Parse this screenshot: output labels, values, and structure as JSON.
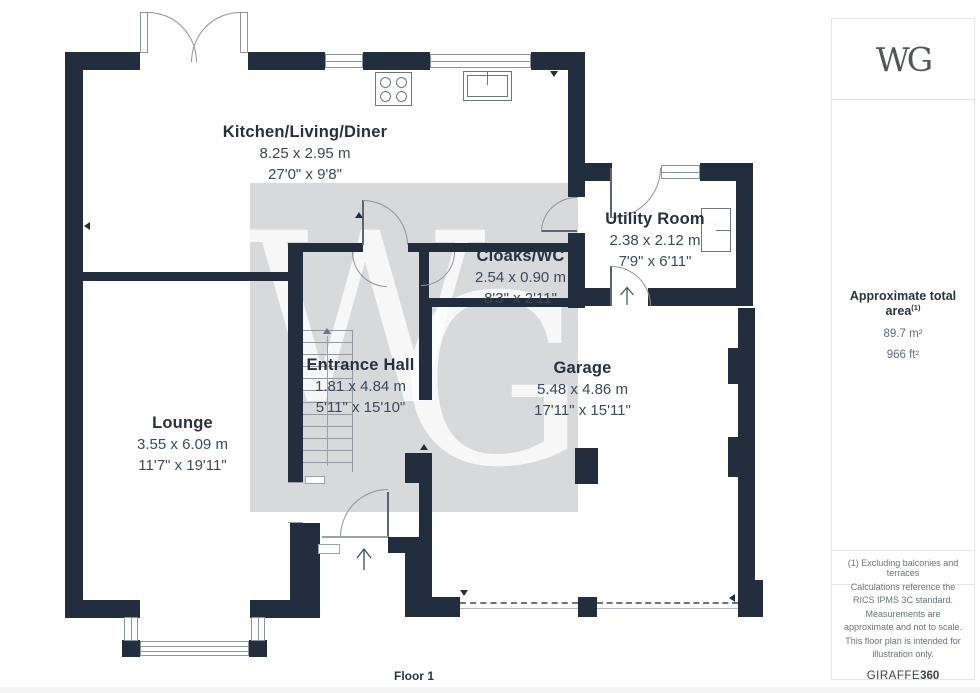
{
  "plan": {
    "floor_label": "Floor 1",
    "wall_color": "#222d3d",
    "watermark_letter_w": "W",
    "watermark_letter_g": "G",
    "rooms": [
      {
        "name": "Kitchen/Living/Diner",
        "metric": "8.25 x 2.95 m",
        "imperial": "27'0\" x 9'8\""
      },
      {
        "name": "Utility Room",
        "metric": "2.38 x 2.12 m",
        "imperial": "7'9\" x 6'11\""
      },
      {
        "name": "Cloaks/WC",
        "metric": "2.54 x 0.90 m",
        "imperial": "8'3\" x 2'11\""
      },
      {
        "name": "Entrance Hall",
        "metric": "1.81 x 4.84 m",
        "imperial": "5'11\" x 15'10\""
      },
      {
        "name": "Garage",
        "metric": "5.48 x 4.86 m",
        "imperial": "17'11\" x 15'11\""
      },
      {
        "name": "Lounge",
        "metric": "3.55 x 6.09 m",
        "imperial": "11'7\" x 19'11\""
      }
    ]
  },
  "sidebar": {
    "logo": "WG",
    "area": {
      "title": "Approximate total area",
      "footnote_marker": "(1)",
      "sqm": "89.7 m²",
      "sqft": "966 ft²"
    },
    "footnote": "(1) Excluding balconies and terraces",
    "disclaimer": "Calculations reference the RICS IPMS 3C standard. Measurements are approximate and not to scale. This floor plan is intended for illustration only.",
    "brand_regular": "GIRAFFE",
    "brand_bold": "360"
  }
}
